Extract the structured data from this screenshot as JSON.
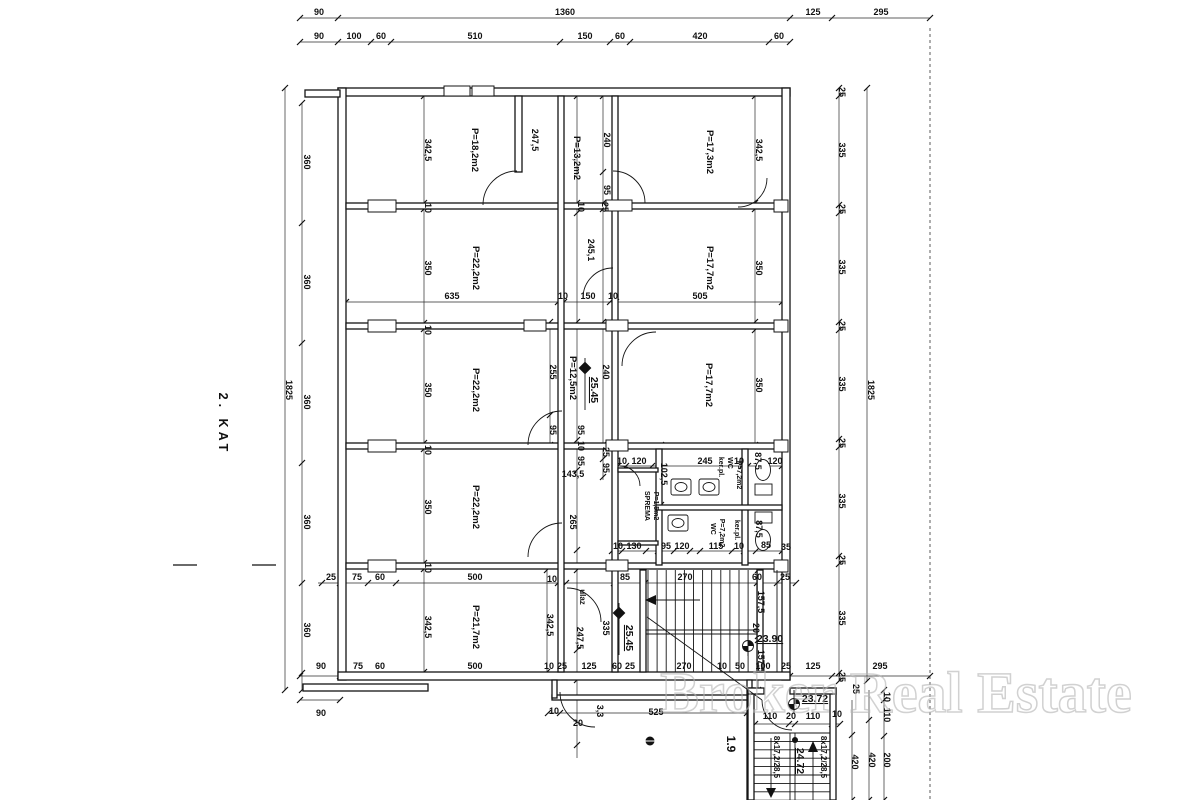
{
  "floor_label": "2. KAT",
  "watermark": "Broker Real Estate",
  "room_labels": [
    {
      "text": "P=18,2m2",
      "x": 472,
      "y": 150
    },
    {
      "text": "P=13,2m2",
      "x": 574,
      "y": 158
    },
    {
      "text": "P=17,3m2",
      "x": 707,
      "y": 152
    },
    {
      "text": "P=22,2m2",
      "x": 473,
      "y": 268
    },
    {
      "text": "P=17,7m2",
      "x": 707,
      "y": 268
    },
    {
      "text": "P=22,2m2",
      "x": 473,
      "y": 390
    },
    {
      "text": "P=12,5m2",
      "x": 570,
      "y": 378
    },
    {
      "text": "P=17,7m2",
      "x": 706,
      "y": 385
    },
    {
      "text": "P=22,2m2",
      "x": 473,
      "y": 507
    },
    {
      "text": "P=21,7m2",
      "x": 473,
      "y": 627
    }
  ],
  "wc_labels": [
    {
      "text": "SPREMA",
      "x": 645,
      "y": 506
    },
    {
      "text": "P=1,5m2",
      "x": 654,
      "y": 506
    },
    {
      "text": "ker.pl.",
      "x": 719,
      "y": 467
    },
    {
      "text": "WC",
      "x": 728,
      "y": 463
    },
    {
      "text": "P=7,2m2",
      "x": 737,
      "y": 475
    },
    {
      "text": "WC",
      "x": 711,
      "y": 529
    },
    {
      "text": "P=7,2m2",
      "x": 720,
      "y": 533
    },
    {
      "text": "ker.pl.",
      "x": 735,
      "y": 530
    }
  ],
  "dim_labels_h": [
    {
      "text": "90",
      "x": 319,
      "y": 15
    },
    {
      "text": "1360",
      "x": 565,
      "y": 15
    },
    {
      "text": "125",
      "x": 813,
      "y": 15
    },
    {
      "text": "295",
      "x": 881,
      "y": 15
    },
    {
      "text": "90",
      "x": 319,
      "y": 39
    },
    {
      "text": "100",
      "x": 354,
      "y": 39
    },
    {
      "text": "60",
      "x": 381,
      "y": 39
    },
    {
      "text": "510",
      "x": 475,
      "y": 39
    },
    {
      "text": "150",
      "x": 585,
      "y": 39
    },
    {
      "text": "60",
      "x": 620,
      "y": 39
    },
    {
      "text": "420",
      "x": 700,
      "y": 39
    },
    {
      "text": "60",
      "x": 779,
      "y": 39
    },
    {
      "text": "635",
      "x": 452,
      "y": 299
    },
    {
      "text": "10",
      "x": 563,
      "y": 299
    },
    {
      "text": "150",
      "x": 588,
      "y": 299
    },
    {
      "text": "10",
      "x": 613,
      "y": 299
    },
    {
      "text": "505",
      "x": 700,
      "y": 299
    },
    {
      "text": "25",
      "x": 331,
      "y": 580
    },
    {
      "text": "75",
      "x": 357,
      "y": 580
    },
    {
      "text": "60",
      "x": 380,
      "y": 580
    },
    {
      "text": "500",
      "x": 475,
      "y": 580
    },
    {
      "text": "10",
      "x": 552,
      "y": 582
    },
    {
      "text": "85",
      "x": 625,
      "y": 580
    },
    {
      "text": "270",
      "x": 685,
      "y": 580
    },
    {
      "text": "60",
      "x": 757,
      "y": 580
    },
    {
      "text": "25",
      "x": 785,
      "y": 580
    },
    {
      "text": "90",
      "x": 321,
      "y": 669
    },
    {
      "text": "75",
      "x": 358,
      "y": 669
    },
    {
      "text": "60",
      "x": 380,
      "y": 669
    },
    {
      "text": "500",
      "x": 475,
      "y": 669
    },
    {
      "text": "10",
      "x": 549,
      "y": 669
    },
    {
      "text": "25",
      "x": 562,
      "y": 669
    },
    {
      "text": "125",
      "x": 589,
      "y": 669
    },
    {
      "text": "60",
      "x": 617,
      "y": 669
    },
    {
      "text": "25",
      "x": 630,
      "y": 669
    },
    {
      "text": "270",
      "x": 684,
      "y": 669
    },
    {
      "text": "10",
      "x": 722,
      "y": 669
    },
    {
      "text": "50",
      "x": 740,
      "y": 669
    },
    {
      "text": "100",
      "x": 763,
      "y": 669
    },
    {
      "text": "25",
      "x": 786,
      "y": 669
    },
    {
      "text": "125",
      "x": 813,
      "y": 669
    },
    {
      "text": "295",
      "x": 880,
      "y": 669
    },
    {
      "text": "90",
      "x": 321,
      "y": 716
    },
    {
      "text": "10",
      "x": 554,
      "y": 714
    },
    {
      "text": "20",
      "x": 578,
      "y": 726
    },
    {
      "text": "525",
      "x": 656,
      "y": 715
    },
    {
      "text": "110",
      "x": 770,
      "y": 719
    },
    {
      "text": "20",
      "x": 791,
      "y": 719
    },
    {
      "text": "110",
      "x": 813,
      "y": 719
    },
    {
      "text": "10",
      "x": 837,
      "y": 717
    },
    {
      "text": "10",
      "x": 622,
      "y": 464
    },
    {
      "text": "120",
      "x": 639,
      "y": 464
    },
    {
      "text": "245",
      "x": 705,
      "y": 464
    },
    {
      "text": "10",
      "x": 739,
      "y": 464
    },
    {
      "text": "120",
      "x": 775,
      "y": 464
    },
    {
      "text": "10",
      "x": 618,
      "y": 549
    },
    {
      "text": "130",
      "x": 634,
      "y": 549
    },
    {
      "text": "95",
      "x": 666,
      "y": 549
    },
    {
      "text": "120",
      "x": 682,
      "y": 549
    },
    {
      "text": "115",
      "x": 716,
      "y": 549
    },
    {
      "text": "10",
      "x": 739,
      "y": 549
    },
    {
      "text": "85",
      "x": 766,
      "y": 548
    },
    {
      "text": "35",
      "x": 786,
      "y": 550
    },
    {
      "text": "143,5",
      "x": 573,
      "y": 477
    }
  ],
  "dim_labels_v": [
    {
      "text": "1825",
      "x": 286,
      "y": 390
    },
    {
      "text": "360",
      "x": 304,
      "y": 162
    },
    {
      "text": "360",
      "x": 304,
      "y": 282
    },
    {
      "text": "360",
      "x": 304,
      "y": 402
    },
    {
      "text": "360",
      "x": 304,
      "y": 522
    },
    {
      "text": "360",
      "x": 304,
      "y": 630
    },
    {
      "text": "342,5",
      "x": 425,
      "y": 150
    },
    {
      "text": "350",
      "x": 425,
      "y": 268
    },
    {
      "text": "350",
      "x": 425,
      "y": 390
    },
    {
      "text": "350",
      "x": 425,
      "y": 507
    },
    {
      "text": "342,5",
      "x": 425,
      "y": 627
    },
    {
      "text": "10",
      "x": 425,
      "y": 208
    },
    {
      "text": "10",
      "x": 425,
      "y": 330
    },
    {
      "text": "10",
      "x": 425,
      "y": 450
    },
    {
      "text": "10",
      "x": 425,
      "y": 568
    },
    {
      "text": "247,5",
      "x": 532,
      "y": 140
    },
    {
      "text": "240",
      "x": 604,
      "y": 140
    },
    {
      "text": "95",
      "x": 604,
      "y": 190
    },
    {
      "text": "25",
      "x": 602,
      "y": 207
    },
    {
      "text": "10",
      "x": 578,
      "y": 207
    },
    {
      "text": "245,1",
      "x": 588,
      "y": 250
    },
    {
      "text": "255",
      "x": 550,
      "y": 372
    },
    {
      "text": "240",
      "x": 603,
      "y": 372
    },
    {
      "text": "95",
      "x": 550,
      "y": 430
    },
    {
      "text": "95",
      "x": 578,
      "y": 430
    },
    {
      "text": "10",
      "x": 578,
      "y": 446
    },
    {
      "text": "95",
      "x": 578,
      "y": 461
    },
    {
      "text": "25",
      "x": 603,
      "y": 452
    },
    {
      "text": "95",
      "x": 603,
      "y": 468
    },
    {
      "text": "265",
      "x": 570,
      "y": 522
    },
    {
      "text": "102,5",
      "x": 661,
      "y": 474
    },
    {
      "text": "87,5",
      "x": 755,
      "y": 461
    },
    {
      "text": "87,5",
      "x": 756,
      "y": 529
    },
    {
      "text": "342,5",
      "x": 756,
      "y": 150
    },
    {
      "text": "350",
      "x": 756,
      "y": 268
    },
    {
      "text": "350",
      "x": 756,
      "y": 385
    },
    {
      "text": "342,5",
      "x": 547,
      "y": 625
    },
    {
      "text": "247,5",
      "x": 577,
      "y": 638
    },
    {
      "text": "335",
      "x": 603,
      "y": 628
    },
    {
      "text": "157,5",
      "x": 758,
      "y": 602
    },
    {
      "text": "157,5",
      "x": 758,
      "y": 661
    },
    {
      "text": "20",
      "x": 753,
      "y": 628
    },
    {
      "text": "25",
      "x": 839,
      "y": 92
    },
    {
      "text": "335",
      "x": 839,
      "y": 150
    },
    {
      "text": "25",
      "x": 839,
      "y": 209
    },
    {
      "text": "335",
      "x": 839,
      "y": 267
    },
    {
      "text": "25",
      "x": 839,
      "y": 326
    },
    {
      "text": "335",
      "x": 839,
      "y": 384
    },
    {
      "text": "25",
      "x": 839,
      "y": 443
    },
    {
      "text": "335",
      "x": 839,
      "y": 501
    },
    {
      "text": "25",
      "x": 839,
      "y": 560
    },
    {
      "text": "335",
      "x": 839,
      "y": 618
    },
    {
      "text": "25",
      "x": 839,
      "y": 677
    },
    {
      "text": "1825",
      "x": 868,
      "y": 390
    },
    {
      "text": "25",
      "x": 853,
      "y": 689
    },
    {
      "text": "10",
      "x": 884,
      "y": 697
    },
    {
      "text": "110",
      "x": 884,
      "y": 715
    },
    {
      "text": "420",
      "x": 852,
      "y": 762
    },
    {
      "text": "420",
      "x": 869,
      "y": 760
    },
    {
      "text": "200",
      "x": 884,
      "y": 760
    },
    {
      "text": "3,3",
      "x": 597,
      "y": 711
    }
  ],
  "elevation_labels": [
    {
      "text": "25.45",
      "x": 591,
      "y": 390,
      "r": 90
    },
    {
      "text": "25.45",
      "x": 626,
      "y": 638,
      "r": 90
    },
    {
      "text": "23.90",
      "x": 770,
      "y": 642,
      "r": 0
    },
    {
      "text": "23.72",
      "x": 815,
      "y": 702,
      "r": 0
    },
    {
      "text": "24.72",
      "x": 797,
      "y": 761,
      "r": 90
    }
  ],
  "stair_labels": [
    {
      "text": "8x17,2/28,5",
      "x": 774,
      "y": 757
    },
    {
      "text": "8x17,2/28,5",
      "x": 821,
      "y": 757
    }
  ],
  "misc_labels": [
    {
      "text": "1.9",
      "x": 727,
      "y": 744,
      "s": 12
    },
    {
      "text": "ulaz",
      "x": 580,
      "y": 597,
      "s": 8
    }
  ]
}
